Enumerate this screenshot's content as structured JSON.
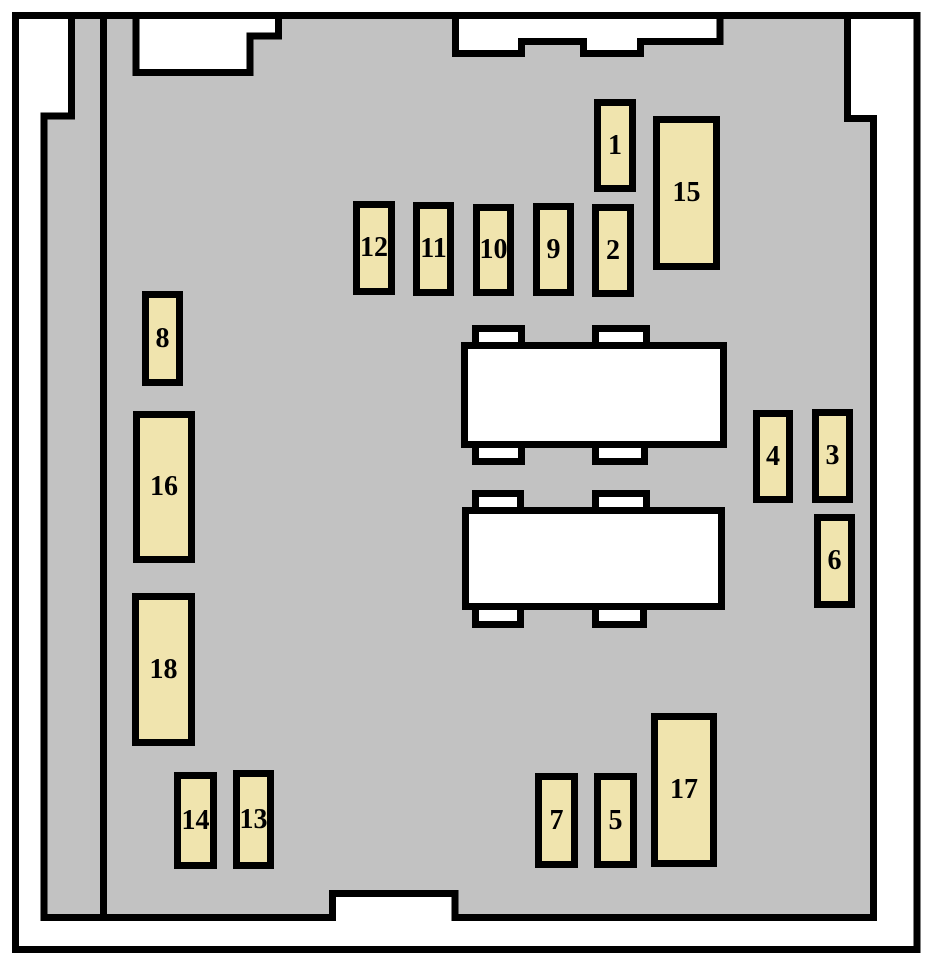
{
  "diagram": {
    "kind": "fuse-box-layout",
    "colors": {
      "canvas": "#FFFFFF",
      "body_fill": "#C2C2C2",
      "outline": "#000000",
      "fuse_fill": "#F0E4AE",
      "connector_fill": "#FFFFFF"
    },
    "fuses": [
      {
        "label": "1",
        "x": 594,
        "y": 99,
        "w": 42,
        "h": 93
      },
      {
        "label": "15",
        "x": 653,
        "y": 116,
        "w": 67,
        "h": 154
      },
      {
        "label": "12",
        "x": 353,
        "y": 201,
        "w": 42,
        "h": 94
      },
      {
        "label": "11",
        "x": 413,
        "y": 202,
        "w": 41,
        "h": 94
      },
      {
        "label": "10",
        "x": 473,
        "y": 204,
        "w": 41,
        "h": 92
      },
      {
        "label": "9",
        "x": 533,
        "y": 203,
        "w": 41,
        "h": 93
      },
      {
        "label": "2",
        "x": 592,
        "y": 204,
        "w": 42,
        "h": 93
      },
      {
        "label": "8",
        "x": 142,
        "y": 291,
        "w": 41,
        "h": 95
      },
      {
        "label": "16",
        "x": 133,
        "y": 411,
        "w": 62,
        "h": 152
      },
      {
        "label": "4",
        "x": 753,
        "y": 410,
        "w": 40,
        "h": 93
      },
      {
        "label": "3",
        "x": 812,
        "y": 409,
        "w": 41,
        "h": 94
      },
      {
        "label": "6",
        "x": 814,
        "y": 514,
        "w": 41,
        "h": 94
      },
      {
        "label": "18",
        "x": 132,
        "y": 593,
        "w": 63,
        "h": 153
      },
      {
        "label": "17",
        "x": 651,
        "y": 713,
        "w": 66,
        "h": 154
      },
      {
        "label": "14",
        "x": 174,
        "y": 772,
        "w": 43,
        "h": 97
      },
      {
        "label": "13",
        "x": 233,
        "y": 770,
        "w": 41,
        "h": 99
      },
      {
        "label": "7",
        "x": 535,
        "y": 773,
        "w": 43,
        "h": 95
      },
      {
        "label": "5",
        "x": 594,
        "y": 773,
        "w": 43,
        "h": 95
      }
    ]
  }
}
